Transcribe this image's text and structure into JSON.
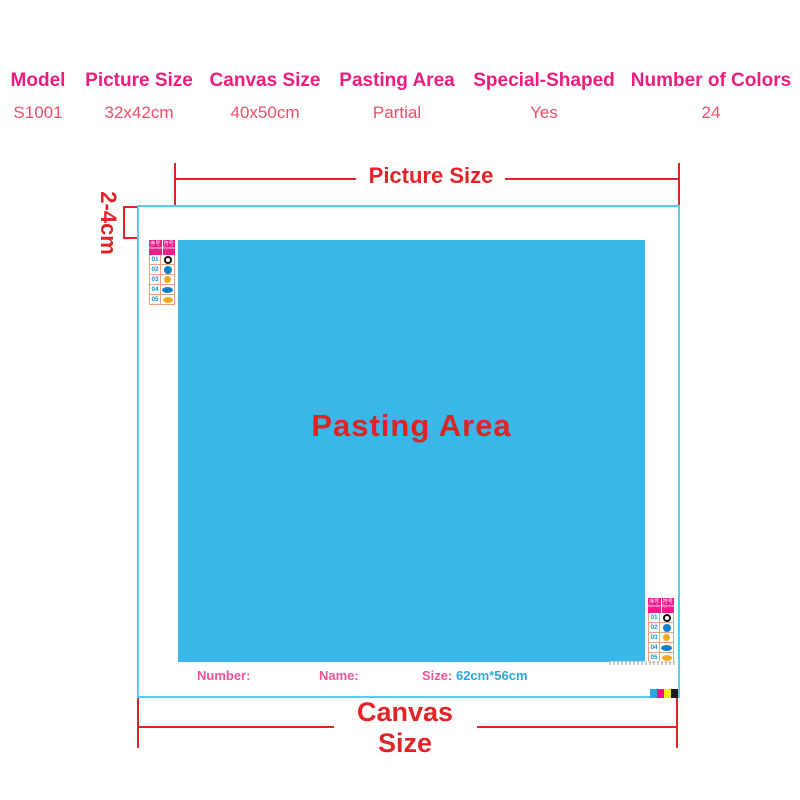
{
  "table": {
    "columns": [
      {
        "header": "Model",
        "value": "S1001"
      },
      {
        "header": "Picture Size",
        "value": "32x42cm"
      },
      {
        "header": "Canvas Size",
        "value": "40x50cm"
      },
      {
        "header": "Pasting Area",
        "value": "Partial"
      },
      {
        "header": "Special-Shaped",
        "value": "Yes"
      },
      {
        "header": "Number of Colors",
        "value": "24"
      }
    ]
  },
  "diagram": {
    "picture_size_label": "Picture Size",
    "canvas_size_label": "Canvas Size",
    "margin_label": "2-4cm",
    "pasting_area_label": "Pasting Area",
    "footer": {
      "number_label": "Number:",
      "name_label": "Name:",
      "size_label": "Size:",
      "size_value": "62cm*56cm"
    },
    "legend": {
      "headers": [
        {
          "cn": "序号",
          "en": "Number"
        },
        {
          "cn": "符号",
          "en": "Symbol"
        }
      ],
      "rows": [
        {
          "num": "01",
          "symbol": "black-donut-icon",
          "cls": "sym s-donut"
        },
        {
          "num": "02",
          "symbol": "blue-circle-icon",
          "cls": "sym s-bcirc"
        },
        {
          "num": "03",
          "symbol": "orange-circle-icon",
          "cls": "sym s-ocirc"
        },
        {
          "num": "04",
          "symbol": "blue-oval-icon",
          "cls": "sym s-boval"
        },
        {
          "num": "05",
          "symbol": "orange-oval-icon",
          "cls": "sym s-ooval"
        }
      ]
    },
    "print_bars": [
      "#29a8e0",
      "#ec108c",
      "#f5eb0a",
      "#1a1a1a"
    ]
  },
  "colors": {
    "table_header_pink": "#ed1c7f",
    "table_value_pink": "#ef4e66",
    "dimension_red": "#e02428",
    "canvas_border_blue": "#62c9ee",
    "pasting_blue": "#39b7e8",
    "footer_pink": "#f0529c",
    "footer_blue": "#29a8e0",
    "legend_header_pink": "#ec1c8d"
  }
}
